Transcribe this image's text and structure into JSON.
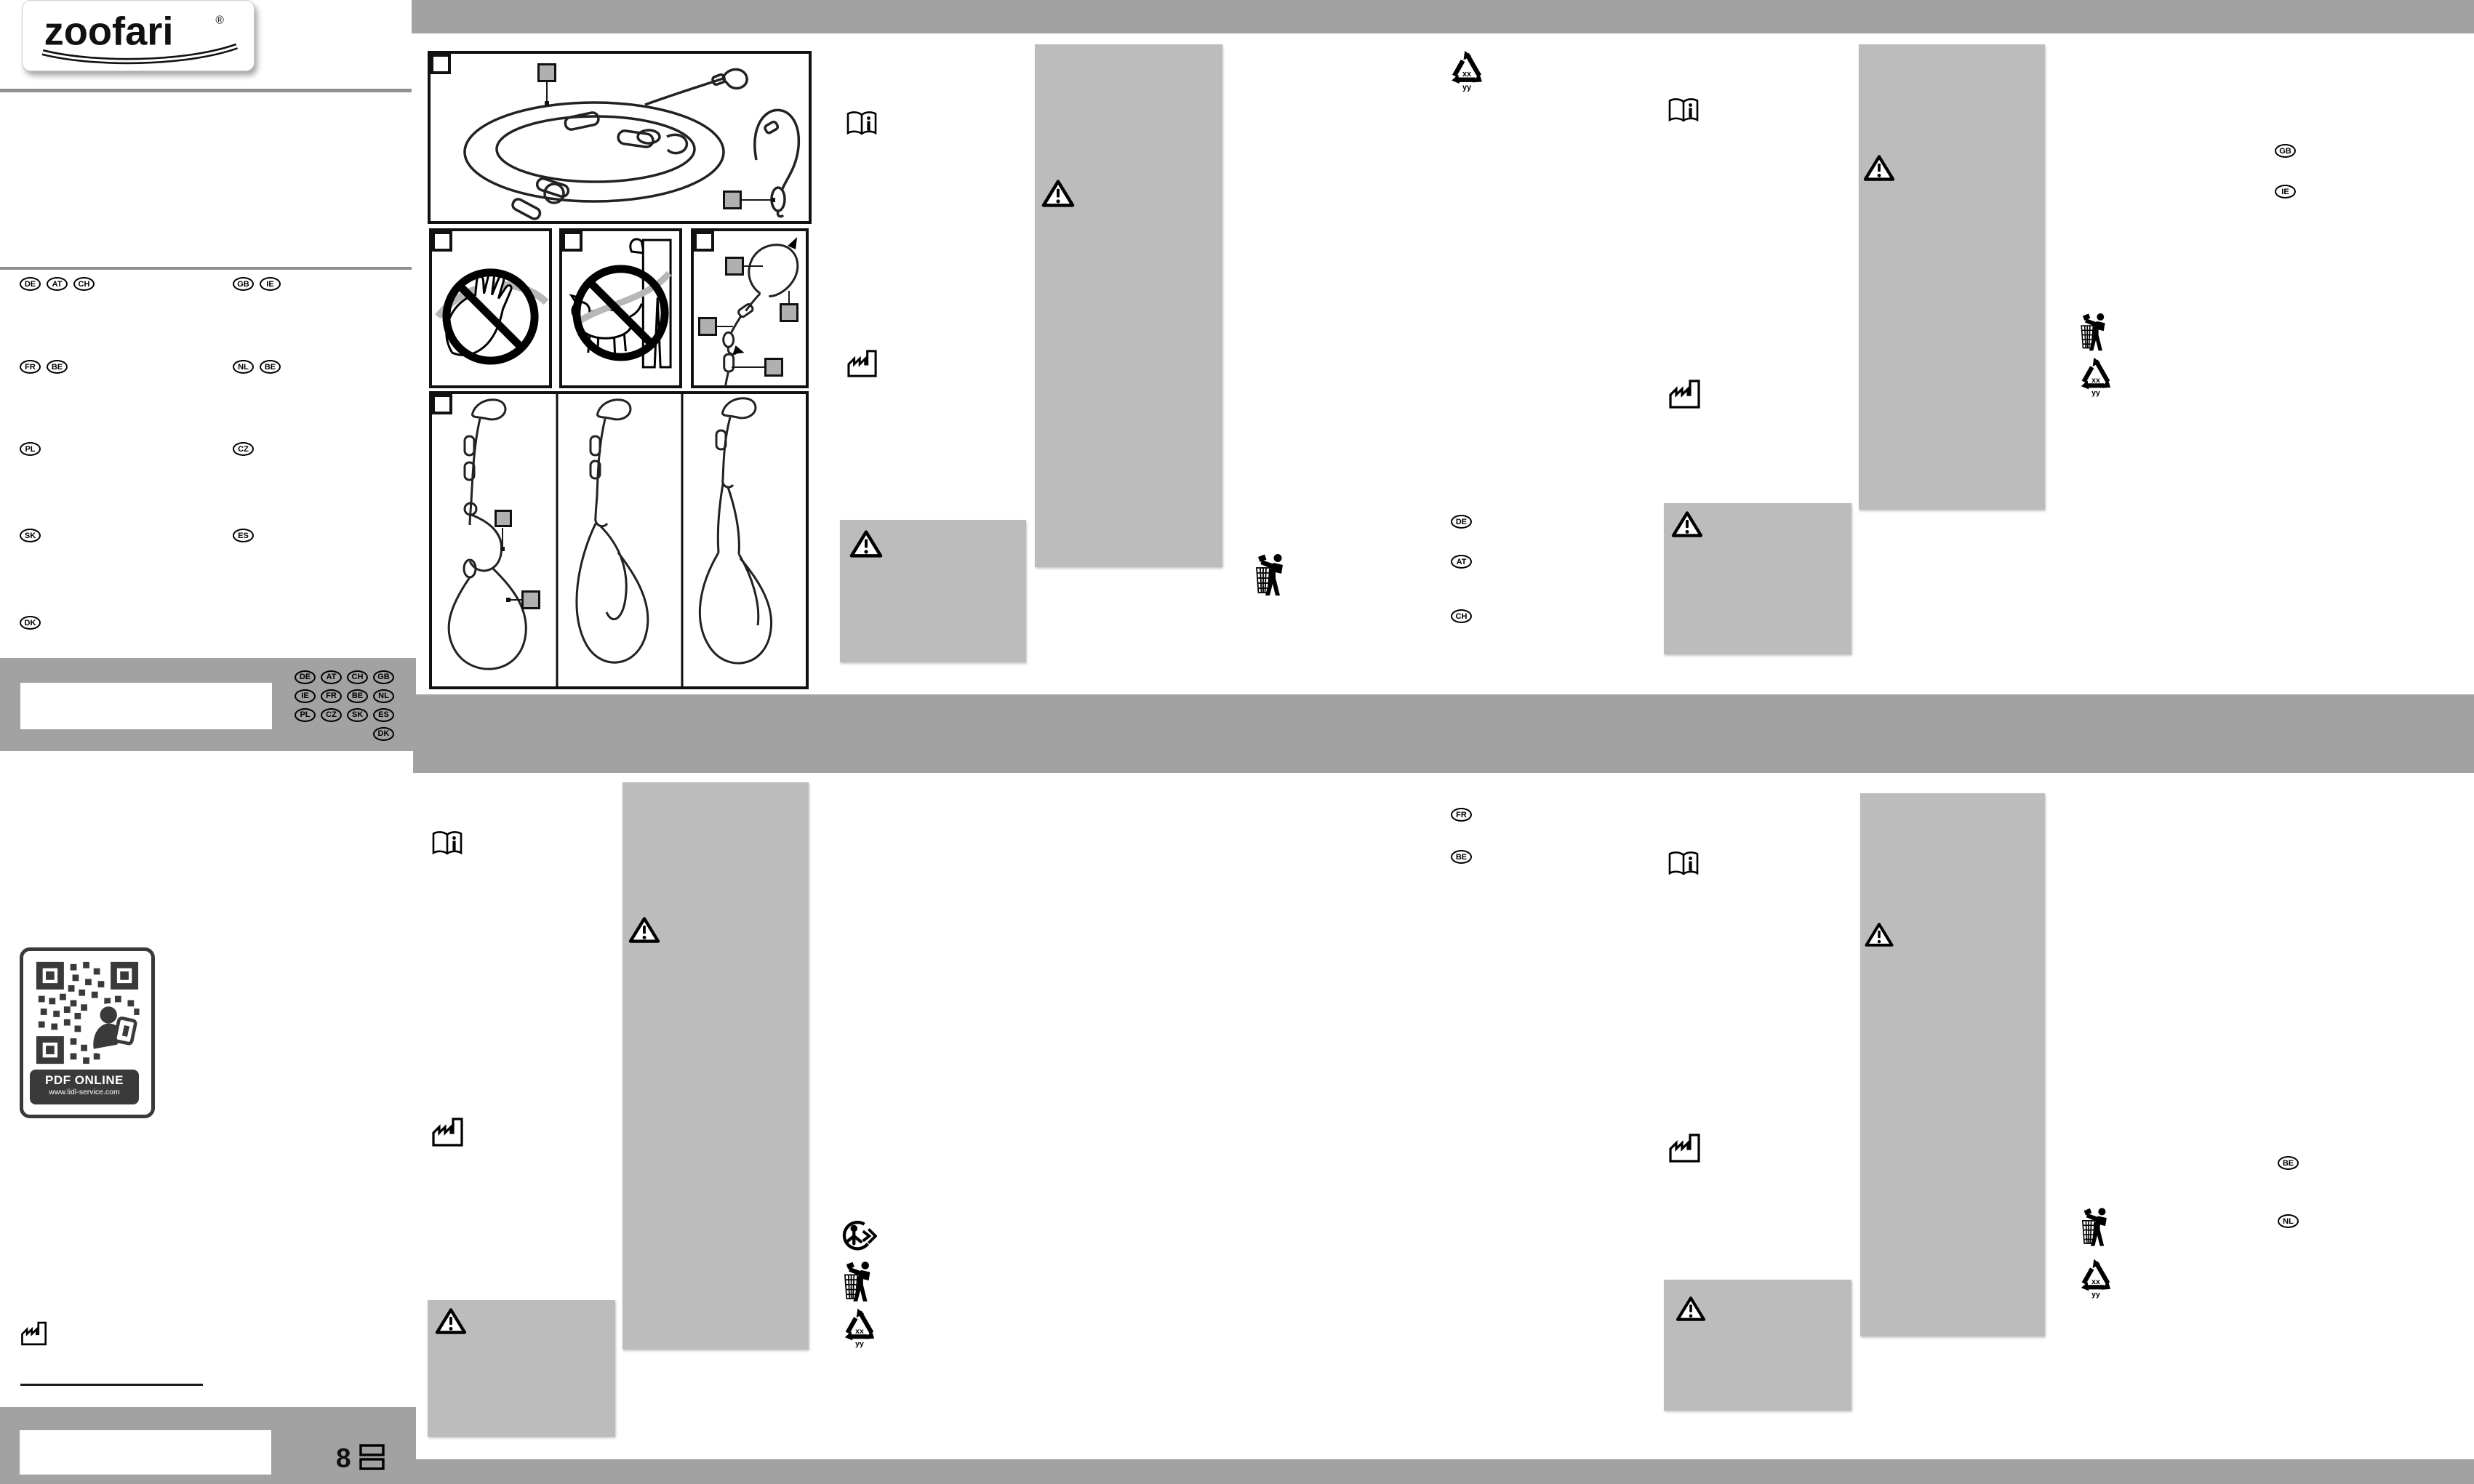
{
  "brand": {
    "name": "zoofari",
    "reg": "®"
  },
  "qr": {
    "title": "PDF ONLINE",
    "url": "www.lidl-service.com"
  },
  "footer": {
    "page_number": "8"
  },
  "recycle": {
    "code_top": "xx",
    "code_bottom": "yy"
  },
  "language_rows": {
    "row1_left": [
      "DE",
      "AT",
      "CH"
    ],
    "row1_right": [
      "GB",
      "IE"
    ],
    "row2_left": [
      "FR",
      "BE"
    ],
    "row2_right": [
      "NL",
      "BE"
    ],
    "row3_left": [
      "PL"
    ],
    "row3_right": [
      "CZ"
    ],
    "row4_left": [
      "SK"
    ],
    "row4_right": [
      "ES"
    ],
    "row5_left": [
      "DK"
    ]
  },
  "badge_grid_flat": [
    "DE",
    "AT",
    "CH",
    "GB",
    "IE",
    "FR",
    "BE",
    "NL",
    "PL",
    "CZ",
    "SK",
    "ES",
    "",
    "",
    "",
    "DK"
  ],
  "section_markers": {
    "de_column": [
      "DE",
      "AT",
      "CH"
    ],
    "gb_column": [
      "GB",
      "IE"
    ],
    "fr_column": [
      "FR",
      "BE"
    ],
    "nl_column": [
      "BE",
      "NL"
    ]
  },
  "icons": {
    "consult_instructions": "open-book-with-i",
    "manufacturer": "factory",
    "warning": "triangle-exclamation",
    "recyclable": "mobius-loop-triangle",
    "dispose_properly": "tidy-man-litter-bin",
    "triman": "triman-recycling",
    "pages": "stacked-pages"
  },
  "colors": {
    "title_band": "#a2a2a2",
    "text_panel": "#bcbcbc",
    "callout_square": "#b0b0b0",
    "qr_label_bg": "#3a3a3a"
  }
}
